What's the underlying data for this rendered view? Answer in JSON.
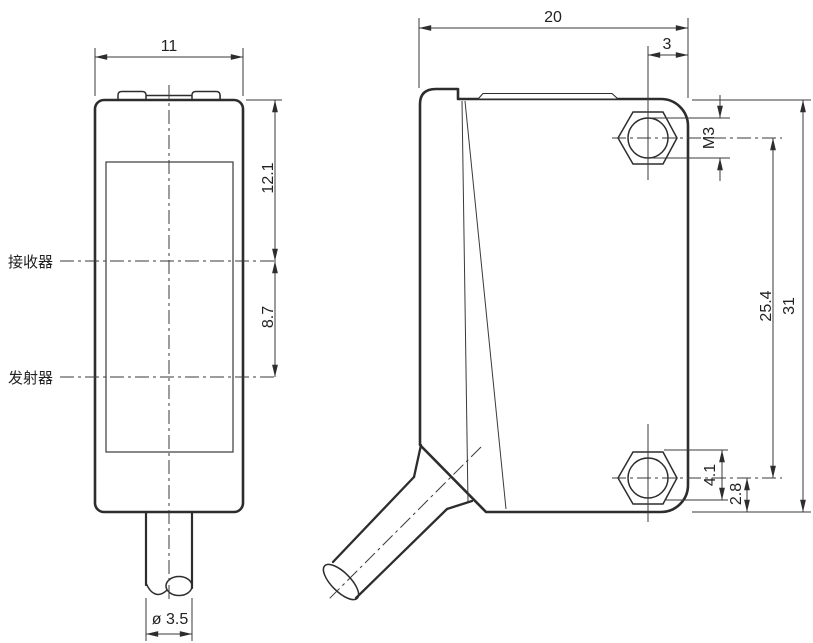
{
  "drawing_title": "sensor-dimension-drawing",
  "left_view": {
    "name": "front-view",
    "width_dim": "11",
    "upper_section_dim": "12.1",
    "lower_section_dim": "8.7",
    "receiver_label": "接收器",
    "emitter_label": "发射器",
    "cable_diameter_dim": "ø 3.5"
  },
  "right_view": {
    "name": "side-view",
    "depth_dim": "20",
    "hole_edge_offset_dim": "3",
    "thread_size_label": "M3",
    "hole_spacing_dim": "25.4",
    "height_dim": "31",
    "hex_recess_dim": "4.1",
    "hole_bottom_offset_dim": "2.8"
  },
  "colors": {
    "line": "#2d2d2d",
    "dimension_line": "#3a3a3a",
    "background": "#ffffff"
  }
}
